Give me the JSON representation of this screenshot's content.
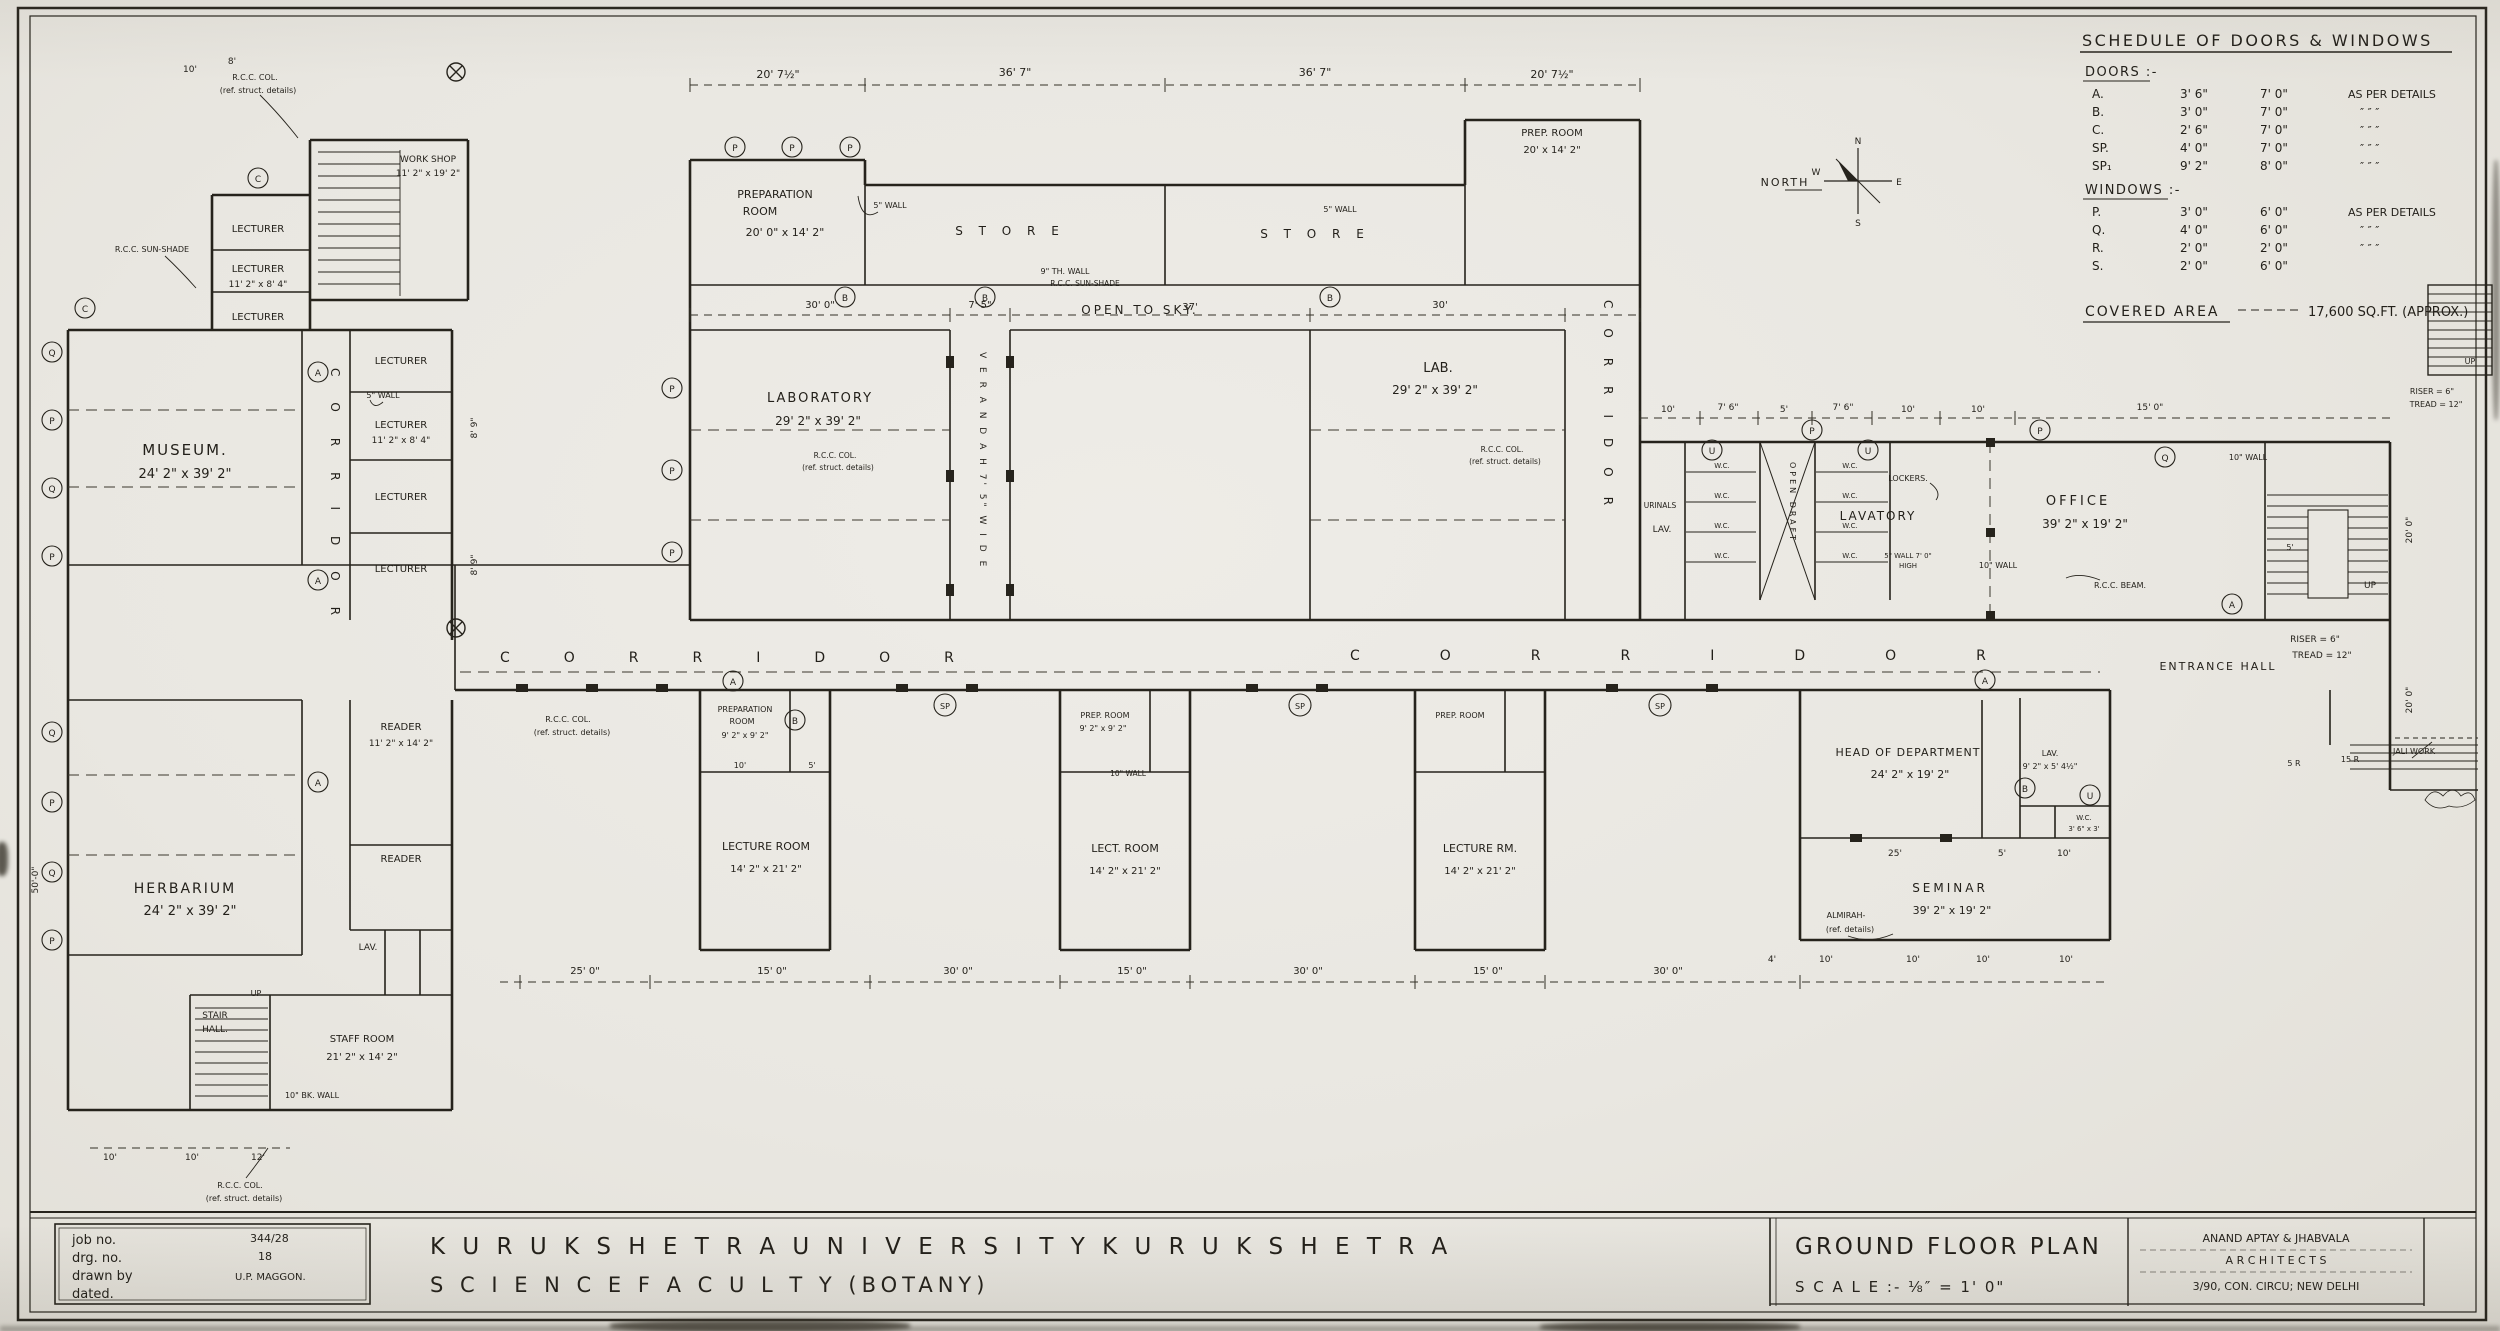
{
  "schedule": {
    "title": "SCHEDULE OF DOORS & WINDOWS",
    "doors_heading": "DOORS :-",
    "windows_heading": "WINDOWS :-",
    "doors": [
      {
        "mark": "A.",
        "w": "3' 6\"",
        "h": "7' 0\"",
        "note": "AS PER DETAILS"
      },
      {
        "mark": "B.",
        "w": "3' 0\"",
        "h": "7' 0\"",
        "note": "″      ″      ″"
      },
      {
        "mark": "C.",
        "w": "2' 6\"",
        "h": "7' 0\"",
        "note": "″      ″      ″"
      },
      {
        "mark": "SP.",
        "w": "4' 0\"",
        "h": "7' 0\"",
        "note": "″      ″      ″"
      },
      {
        "mark": "SP₁",
        "w": "9' 2\"",
        "h": "8' 0\"",
        "note": "″      ″      ″"
      }
    ],
    "windows": [
      {
        "mark": "P.",
        "w": "3' 0\"",
        "h": "6' 0\"",
        "note": "AS PER DETAILS"
      },
      {
        "mark": "Q.",
        "w": "4' 0\"",
        "h": "6' 0\"",
        "note": "″      ″      ″"
      },
      {
        "mark": "R.",
        "w": "2' 0\"",
        "h": "2' 0\"",
        "note": "″      ″      ″"
      },
      {
        "mark": "S.",
        "w": "2' 0\"",
        "h": "6' 0\"",
        "note": ""
      }
    ],
    "covered_area_label": "COVERED AREA",
    "covered_area_value": "17,600 SQ.FT. (APPROX.)"
  },
  "compass": {
    "label": "NORTH",
    "n": "N",
    "e": "E",
    "s": "S",
    "w": "W"
  },
  "corridor": {
    "label": "CORRIDOR"
  },
  "rooms": {
    "workshop": {
      "name": "WORK SHOP",
      "dims": "11' 2\" x 19' 2\""
    },
    "museum": {
      "name": "MUSEUM.",
      "dims": "24' 2\" x 39' 2\""
    },
    "herbarium": {
      "name": "HERBARIUM",
      "dims": "24' 2\" x 39' 2\""
    },
    "lecturer": {
      "name": "LECTURER",
      "dims": "11' 2\" x 8' 4\""
    },
    "reader": {
      "name": "READER",
      "dims": "11' 2\" x 14' 2\""
    },
    "staff": {
      "name": "STAFF ROOM",
      "dims": "21' 2\" x 14' 2\""
    },
    "stair_hall1": "STAIR",
    "stair_hall2": "HALL.",
    "lav": "LAV.",
    "prep_left": {
      "name1": "PREPARATION",
      "name2": "ROOM",
      "dims": "20' 0\" x 14' 2\""
    },
    "laboratory": {
      "name": "LABORATORY",
      "dims": "29' 2\" x 39' 2\""
    },
    "store": {
      "name": "S  T  O  R  E"
    },
    "lab": {
      "name": "LAB.",
      "dims": "29' 2\" x 39' 2\""
    },
    "prep_right": {
      "name": "PREP. ROOM",
      "dims": "20' x 14' 2\""
    },
    "open_sky": "OPEN   TO   SKY.",
    "lavatory": "LAVATORY",
    "office": {
      "name": "OFFICE",
      "dims": "39' 2\" x 19' 2\""
    },
    "entrance": "ENTRANCE   HALL",
    "hod": {
      "name": "HEAD OF DEPARTMENT",
      "dims": "24' 2\" x 19' 2\""
    },
    "seminar": {
      "name": "SEMINAR",
      "dims": "39' 2\" x 19' 2\""
    },
    "lav_r": {
      "name": "LAV.",
      "dims": "9' 2\" x 5' 4½\""
    },
    "wc_r": {
      "name": "W.C.",
      "dims": "3' 6\" x 3'"
    },
    "prep_b1": {
      "name1": "PREPARATION",
      "name2": "ROOM",
      "dims": "9' 2\" x 9' 2\""
    },
    "lecture1": {
      "name": "LECTURE ROOM",
      "dims": "14' 2\" x 21' 2\""
    },
    "prep_b2": {
      "name": "PREP. ROOM",
      "dims": "9' 2\" x 9' 2\""
    },
    "lecture2": {
      "name": "LECT. ROOM",
      "dims": "14' 2\" x 21' 2\""
    },
    "prep_b3": {
      "name": "PREP. ROOM"
    },
    "lecture3": {
      "name": "LECTURE RM.",
      "dims": "14' 2\" x 21' 2\""
    }
  },
  "annotations": {
    "rcc_col": "R.C.C. COL.",
    "ref_struct": "(ref. struct. details)",
    "rcc_sunshade": "R.C.C. SUN-SHADE",
    "rcc_beam": "R.C.C. BEAM.",
    "wall5": "5\" WALL",
    "wall9": "9\" TH. WALL",
    "wall10": "10\" WALL",
    "bkwall10": "10\" BK. WALL",
    "wall5high": "5\" WALL 7' 0\"",
    "high": "HIGH",
    "up": "UP",
    "lockers": "LOCKERS.",
    "urinals": "URINALS",
    "open_draft": "OPEN  DRAFT",
    "wc": "W.C.",
    "almirah1": "ALMIRAH-",
    "almirah2": "(ref. details)",
    "jali": "JALI WORK",
    "steps5r": "5 R",
    "steps15r": "15 R",
    "verandah": "V E R A N D A H   7' 5\"  W I D E",
    "riser": "RISER = 6\"",
    "tread": "TREAD = 12\""
  },
  "dims": {
    "top": [
      "20' 7½\"",
      "36' 7\"",
      "36' 7\"",
      "20' 7½\""
    ],
    "mid": [
      "30' 0\"",
      "7' 5\"",
      "37'",
      "30'"
    ],
    "bottom": [
      "25' 0\"",
      "15' 0\"",
      "30' 0\"",
      "15' 0\"",
      "30' 0\"",
      "15' 0\"",
      "30' 0\""
    ],
    "lav_top": [
      "10'",
      "7' 6\"",
      "5'",
      "7' 6\"",
      "10'",
      "10'",
      "15' 0\""
    ],
    "hod": [
      "25'",
      "5'",
      "10'"
    ],
    "sem_bottom": [
      "4'",
      "10'",
      "10'",
      "10'",
      "10'"
    ],
    "left_bottom": [
      "10'",
      "10'",
      "12'"
    ],
    "left_top": [
      "10'",
      "8'"
    ],
    "prep_small": [
      "10'",
      "5'"
    ],
    "lect_side": "8' 9\"",
    "right_v": "20' 0\"",
    "left_v": "50'-0\""
  },
  "marks": {
    "a": "A",
    "b": "B",
    "c": "C",
    "p": "P",
    "q": "Q",
    "r": "R",
    "s": "S",
    "u": "U",
    "sp": "SP",
    "e": "E"
  },
  "titleblock": {
    "job_label": "job no.",
    "drg_label": "drg. no.",
    "drawn_label": "drawn by",
    "dated_label": "dated.",
    "job_value": "344/28",
    "drg_value": "18",
    "drawn_value": "U.P. MAGGON.",
    "line1": "K U R U K S H E T R A       U N I V E R S I T Y       K U R U K S H E T R A",
    "line2": "S C I E N C E       F A C U L T Y       (BOTANY)",
    "plan_title": "GROUND  FLOOR  PLAN",
    "scale": "S C A L E :-  ⅛″ = 1' 0\"",
    "arch1": "ANAND   APTAY   &   JHABVALA",
    "arch2": "A R C H I T E C T S",
    "arch3": "3/90, CON. CIRCU;  NEW DELHI"
  }
}
